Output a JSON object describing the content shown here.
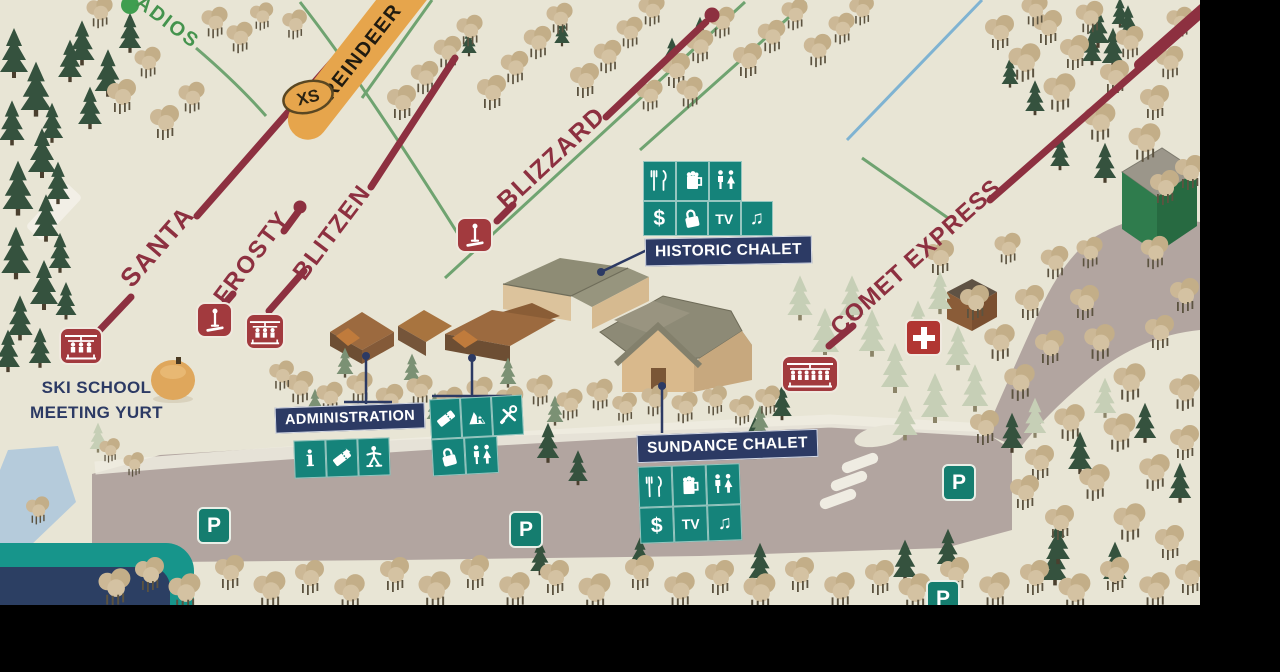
{
  "trails": {
    "santa": "SANTA",
    "frosty": "FROSTY",
    "blitzen": "BLITZEN",
    "blizzard": "BLIZZARD",
    "comet_express": "COMET EXPRESS",
    "adios": "ADIOS",
    "reindeer": "REINDEER",
    "reindeer_badge": "XS"
  },
  "facilities": {
    "historic_chalet": {
      "label": "HISTORIC CHALET",
      "amenities_row1": [
        "dining",
        "bar",
        "restrooms"
      ],
      "amenities_row2": [
        "atm",
        "lockers",
        "tv",
        "music"
      ]
    },
    "sundance_chalet": {
      "label": "SUNDANCE CHALET",
      "amenities_row1": [
        "dining",
        "bar",
        "restrooms"
      ],
      "amenities_row2": [
        "atm",
        "tv",
        "music"
      ]
    },
    "administration": {
      "label": "ADMINISTRATION",
      "amenities": [
        "information",
        "tickets",
        "ski-school"
      ]
    },
    "rental_shop": {
      "amenities_row1": [
        "tickets",
        "rentals",
        "repairs"
      ],
      "amenities_row2": [
        "lockers",
        "restrooms"
      ]
    },
    "ski_school": {
      "line1": "SKI SCHOOL",
      "line2": "MEETING YURT"
    }
  },
  "glyphs": {
    "parking": "P",
    "dollar": "$",
    "tv": "TV",
    "music": "♫",
    "info": "i",
    "rental_r": "R"
  },
  "markers": {
    "first_aid": "first-aid-cross",
    "chairlifts": [
      "santa-base",
      "blitzen-base",
      "comet-express-base"
    ],
    "surface_lifts": [
      "frosty-base",
      "blizzard-base"
    ],
    "parking_count": 4
  },
  "colors": {
    "snow": "#e8e5d5",
    "trail_maroon": "#8d3040",
    "amenity_teal": "#15837a",
    "label_navy": "#2c3a64",
    "banner_orange": "#e6a54c",
    "easy_green": "#69a06b",
    "blue_trail": "#7fb3d2",
    "parking_lot": "#b2a5a0",
    "first_aid_red": "#b13632",
    "adios_green": "#44934d"
  }
}
